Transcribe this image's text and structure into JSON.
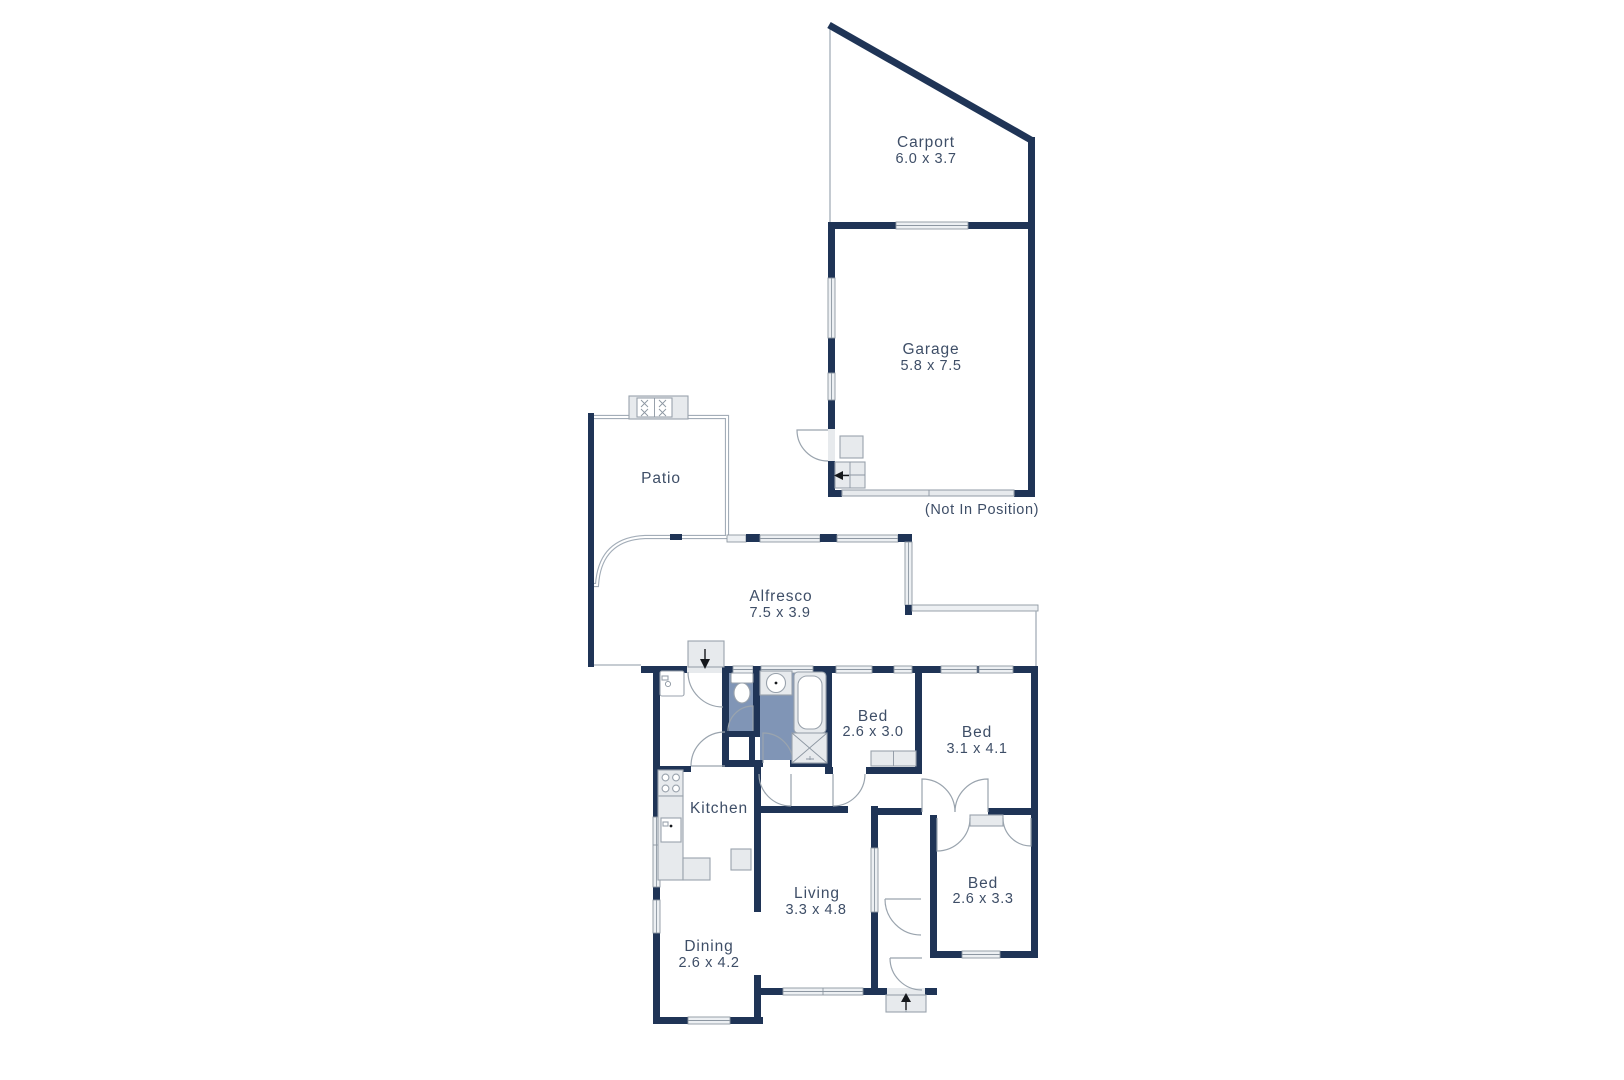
{
  "plan": {
    "note": "(Not In Position)",
    "colors": {
      "wall": "#1f3456",
      "wet_area": "#8095b6",
      "fixture": "#e7eaed",
      "window": "#edf0f3",
      "outline": "#a3adb8",
      "text": "#3e4e67"
    },
    "rooms": {
      "carport": {
        "name": "Carport",
        "dims": "6.0 x 3.7"
      },
      "garage": {
        "name": "Garage",
        "dims": "5.8 x 7.5"
      },
      "patio": {
        "name": "Patio"
      },
      "alfresco": {
        "name": "Alfresco",
        "dims": "7.5 x 3.9"
      },
      "bed1": {
        "name": "Bed",
        "dims": "2.6 x 3.0"
      },
      "bed2": {
        "name": "Bed",
        "dims": "3.1 x 4.1"
      },
      "bed3": {
        "name": "Bed",
        "dims": "2.6 x 3.3"
      },
      "kitchen": {
        "name": "Kitchen"
      },
      "living": {
        "name": "Living",
        "dims": "3.3 x 4.8"
      },
      "dining": {
        "name": "Dining",
        "dims": "2.6 x 4.2"
      }
    }
  }
}
